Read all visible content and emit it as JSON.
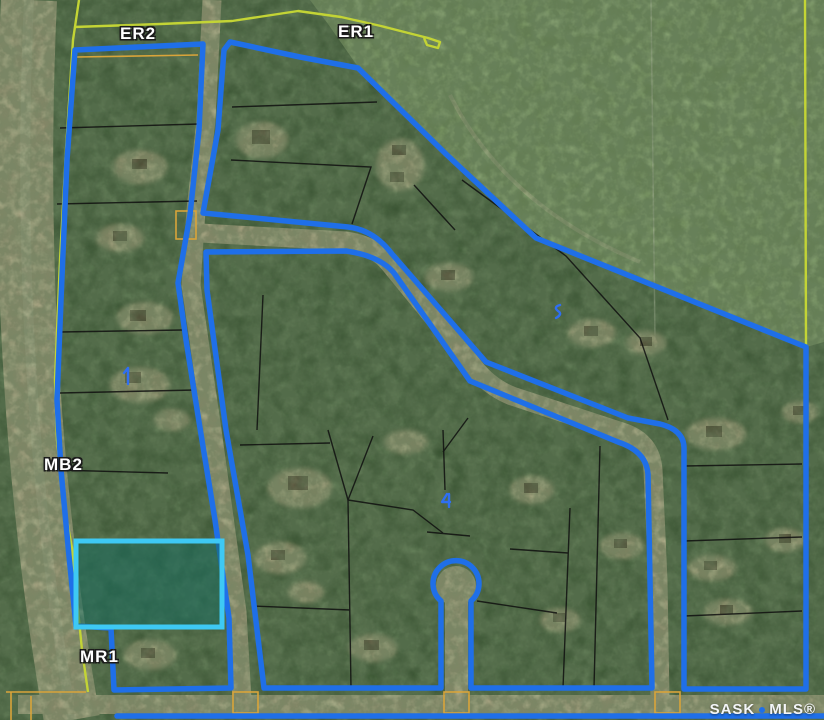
{
  "map": {
    "type": "aerial-parcel-map",
    "zone_labels": [
      {
        "id": "er2",
        "text": "ER2"
      },
      {
        "id": "er1",
        "text": "ER1"
      },
      {
        "id": "mb2",
        "text": "MB2"
      },
      {
        "id": "mr1",
        "text": "MR1"
      }
    ],
    "watermark": {
      "brand_left": "SASK",
      "brand_right": "MLS®"
    },
    "highlighted_parcel": {
      "description": "listing lot outlined in cyan with teal fill"
    },
    "markers": [
      {
        "id": "marker-1",
        "shape": "digit-like blue glyph"
      },
      {
        "id": "marker-2",
        "shape": "digit-like blue glyph"
      },
      {
        "id": "marker-3",
        "shape": "digit-like blue glyph"
      }
    ],
    "colors": {
      "boundary": "#1f6fe8",
      "quarter_line": "#c3d435",
      "lot_line": "#101010",
      "survey_line": "#d9a43a",
      "highlight_stroke": "#3ec9f4",
      "highlight_fill": "rgba(23,108,94,0.55)",
      "forest": "#35522e",
      "field": "#7e9b63",
      "road": "#c0af8e",
      "marker": "#2f6ff2",
      "label_text": "#ffffff"
    }
  }
}
